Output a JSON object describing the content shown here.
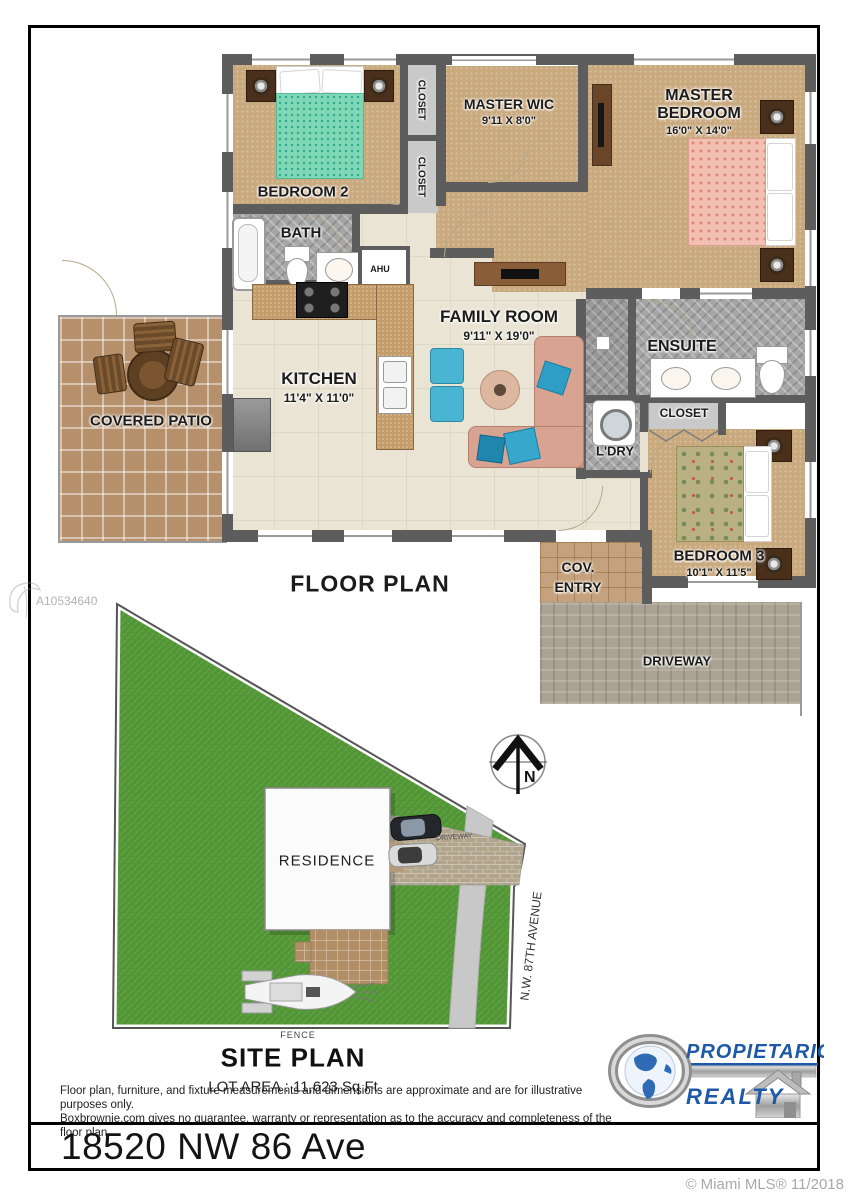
{
  "page": {
    "address": "18520 NW 86 Ave"
  },
  "watermarks": {
    "listing_id": "A10534640",
    "mls_credit": "© Miami MLS® 11/2018"
  },
  "floor_plan": {
    "title": "FLOOR PLAN",
    "bedroom2": {
      "name": "BEDROOM 2"
    },
    "closet_a": {
      "name": "CLOSET"
    },
    "closet_b": {
      "name": "CLOSET"
    },
    "master_wic": {
      "name": "MASTER WIC",
      "dims": "9'11 X 8'0\""
    },
    "master_bedroom": {
      "line1": "MASTER",
      "line2": "BEDROOM",
      "dims": "16'0\" X 14'0\""
    },
    "bath": {
      "name": "BATH"
    },
    "ahu": {
      "name": "AHU"
    },
    "family_room": {
      "name": "FAMILY ROOM",
      "dims": "9'11\" X 19'0\""
    },
    "kitchen": {
      "name": "KITCHEN",
      "dims": "11'4\" X 11'0\""
    },
    "covered_patio": {
      "name": "COVERED PATIO"
    },
    "ensuite": {
      "name": "ENSUITE"
    },
    "closet_c": {
      "name": "CLOSET"
    },
    "laundry": {
      "name": "L'DRY"
    },
    "bedroom3": {
      "name": "BEDROOM 3",
      "dims": "10'1\" X 11'5\""
    },
    "cov_entry": {
      "line1": "COV.",
      "line2": "ENTRY"
    },
    "driveway": {
      "name": "DRIVEWAY"
    }
  },
  "site_plan": {
    "title": "SITE PLAN",
    "lot_area": "LOT AREA : 11,623 Sq Ft",
    "residence": "RESIDENCE",
    "driveway": "DRIVEWAY",
    "street": "N.W. 87TH AVENUE",
    "fence": "FENCE",
    "compass_north": "N"
  },
  "disclaimer": {
    "line1": "Floor plan, furniture, and fixture measurements and dimensions are approximate and are for illustrative purposes only.",
    "line2": "Boxbrownie.com gives no guarantee, warranty or representation as to the accuracy and completeness of the floor plan."
  },
  "logo": {
    "line1": "PROPIETARIO",
    "line2": "REALTY"
  },
  "colors": {
    "wall": "#5d5d5d",
    "tan_floor": "#c9a97e",
    "beige_floor": "#eae4d4",
    "grass": "#55993a",
    "logo_blue": "#1d59a8"
  }
}
